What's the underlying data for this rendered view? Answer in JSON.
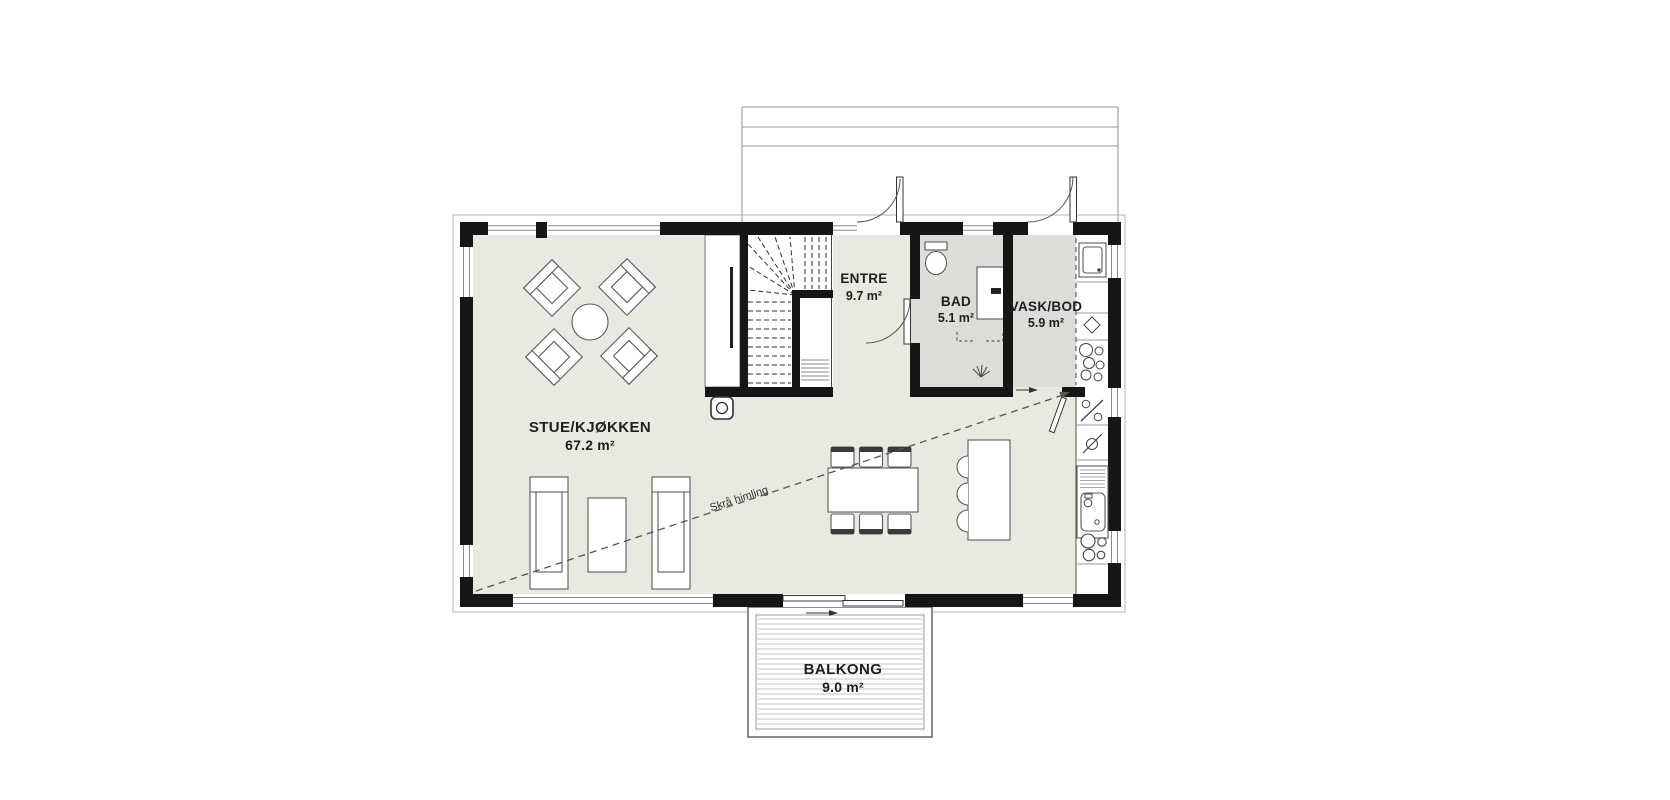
{
  "rooms": [
    {
      "name": "STUE/KJØKKEN",
      "area": "67.2 m²"
    },
    {
      "name": "ENTRE",
      "area": "9.7 m²"
    },
    {
      "name": "BAD",
      "area": "5.1 m²"
    },
    {
      "name": "VASK/BOD",
      "area": "5.9 m²"
    },
    {
      "name": "BALKONG",
      "area": "9.0 m²"
    }
  ],
  "annotations": {
    "ceiling_note": "Skrå himling"
  },
  "colors": {
    "wall": "#161616",
    "floor_main": "#e9e8e1",
    "floor_wet": "#dcddd9",
    "deck_line": "#9a9a9a",
    "background": "#ffffff"
  }
}
